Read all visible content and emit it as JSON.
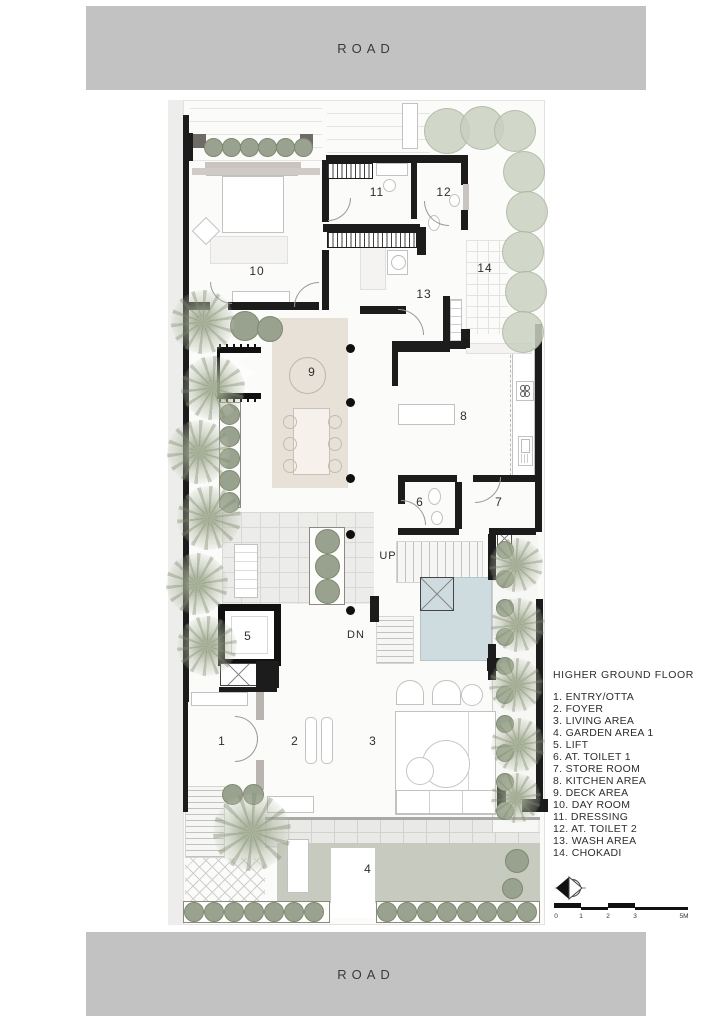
{
  "road_top_label": "ROAD",
  "road_bottom_label": "ROAD",
  "legend": {
    "title": "HIGHER GROUND FLOOR",
    "items": [
      "1. ENTRY/OTTA",
      "2. FOYER",
      "3. LIVING AREA",
      "4. GARDEN AREA 1",
      "5. LIFT",
      "6. AT. TOILET 1",
      "7. STORE ROOM",
      "8. KITCHEN AREA",
      "9. DECK AREA",
      "10. DAY ROOM",
      "11. DRESSING",
      "12. AT. TOILET 2",
      "13. WASH AREA",
      "14. CHOKADI"
    ]
  },
  "plan_labels": {
    "r1": "1",
    "r2": "2",
    "r3": "3",
    "r4": "4",
    "r5": "5",
    "r6": "6",
    "r7": "7",
    "r8": "8",
    "r9": "9",
    "r10": "10",
    "r11": "11",
    "r12": "12",
    "r13": "13",
    "r14": "14",
    "up": "UP",
    "dn": "DN"
  },
  "scale_bar": {
    "ticks": [
      "0",
      "1",
      "2",
      "3",
      "5M"
    ]
  },
  "icons": {
    "north_arrow": "north-compass-icon"
  },
  "colors": {
    "road_gray": "#c2c2c2",
    "wall_black": "#1c1c1c",
    "deck_tan": "#e8e1d8",
    "pool_blue": "#cfdcdf",
    "lawn_green": "#c6cabf",
    "shrub_green": "#99a28f",
    "tree_green": "#c9d0bf"
  }
}
